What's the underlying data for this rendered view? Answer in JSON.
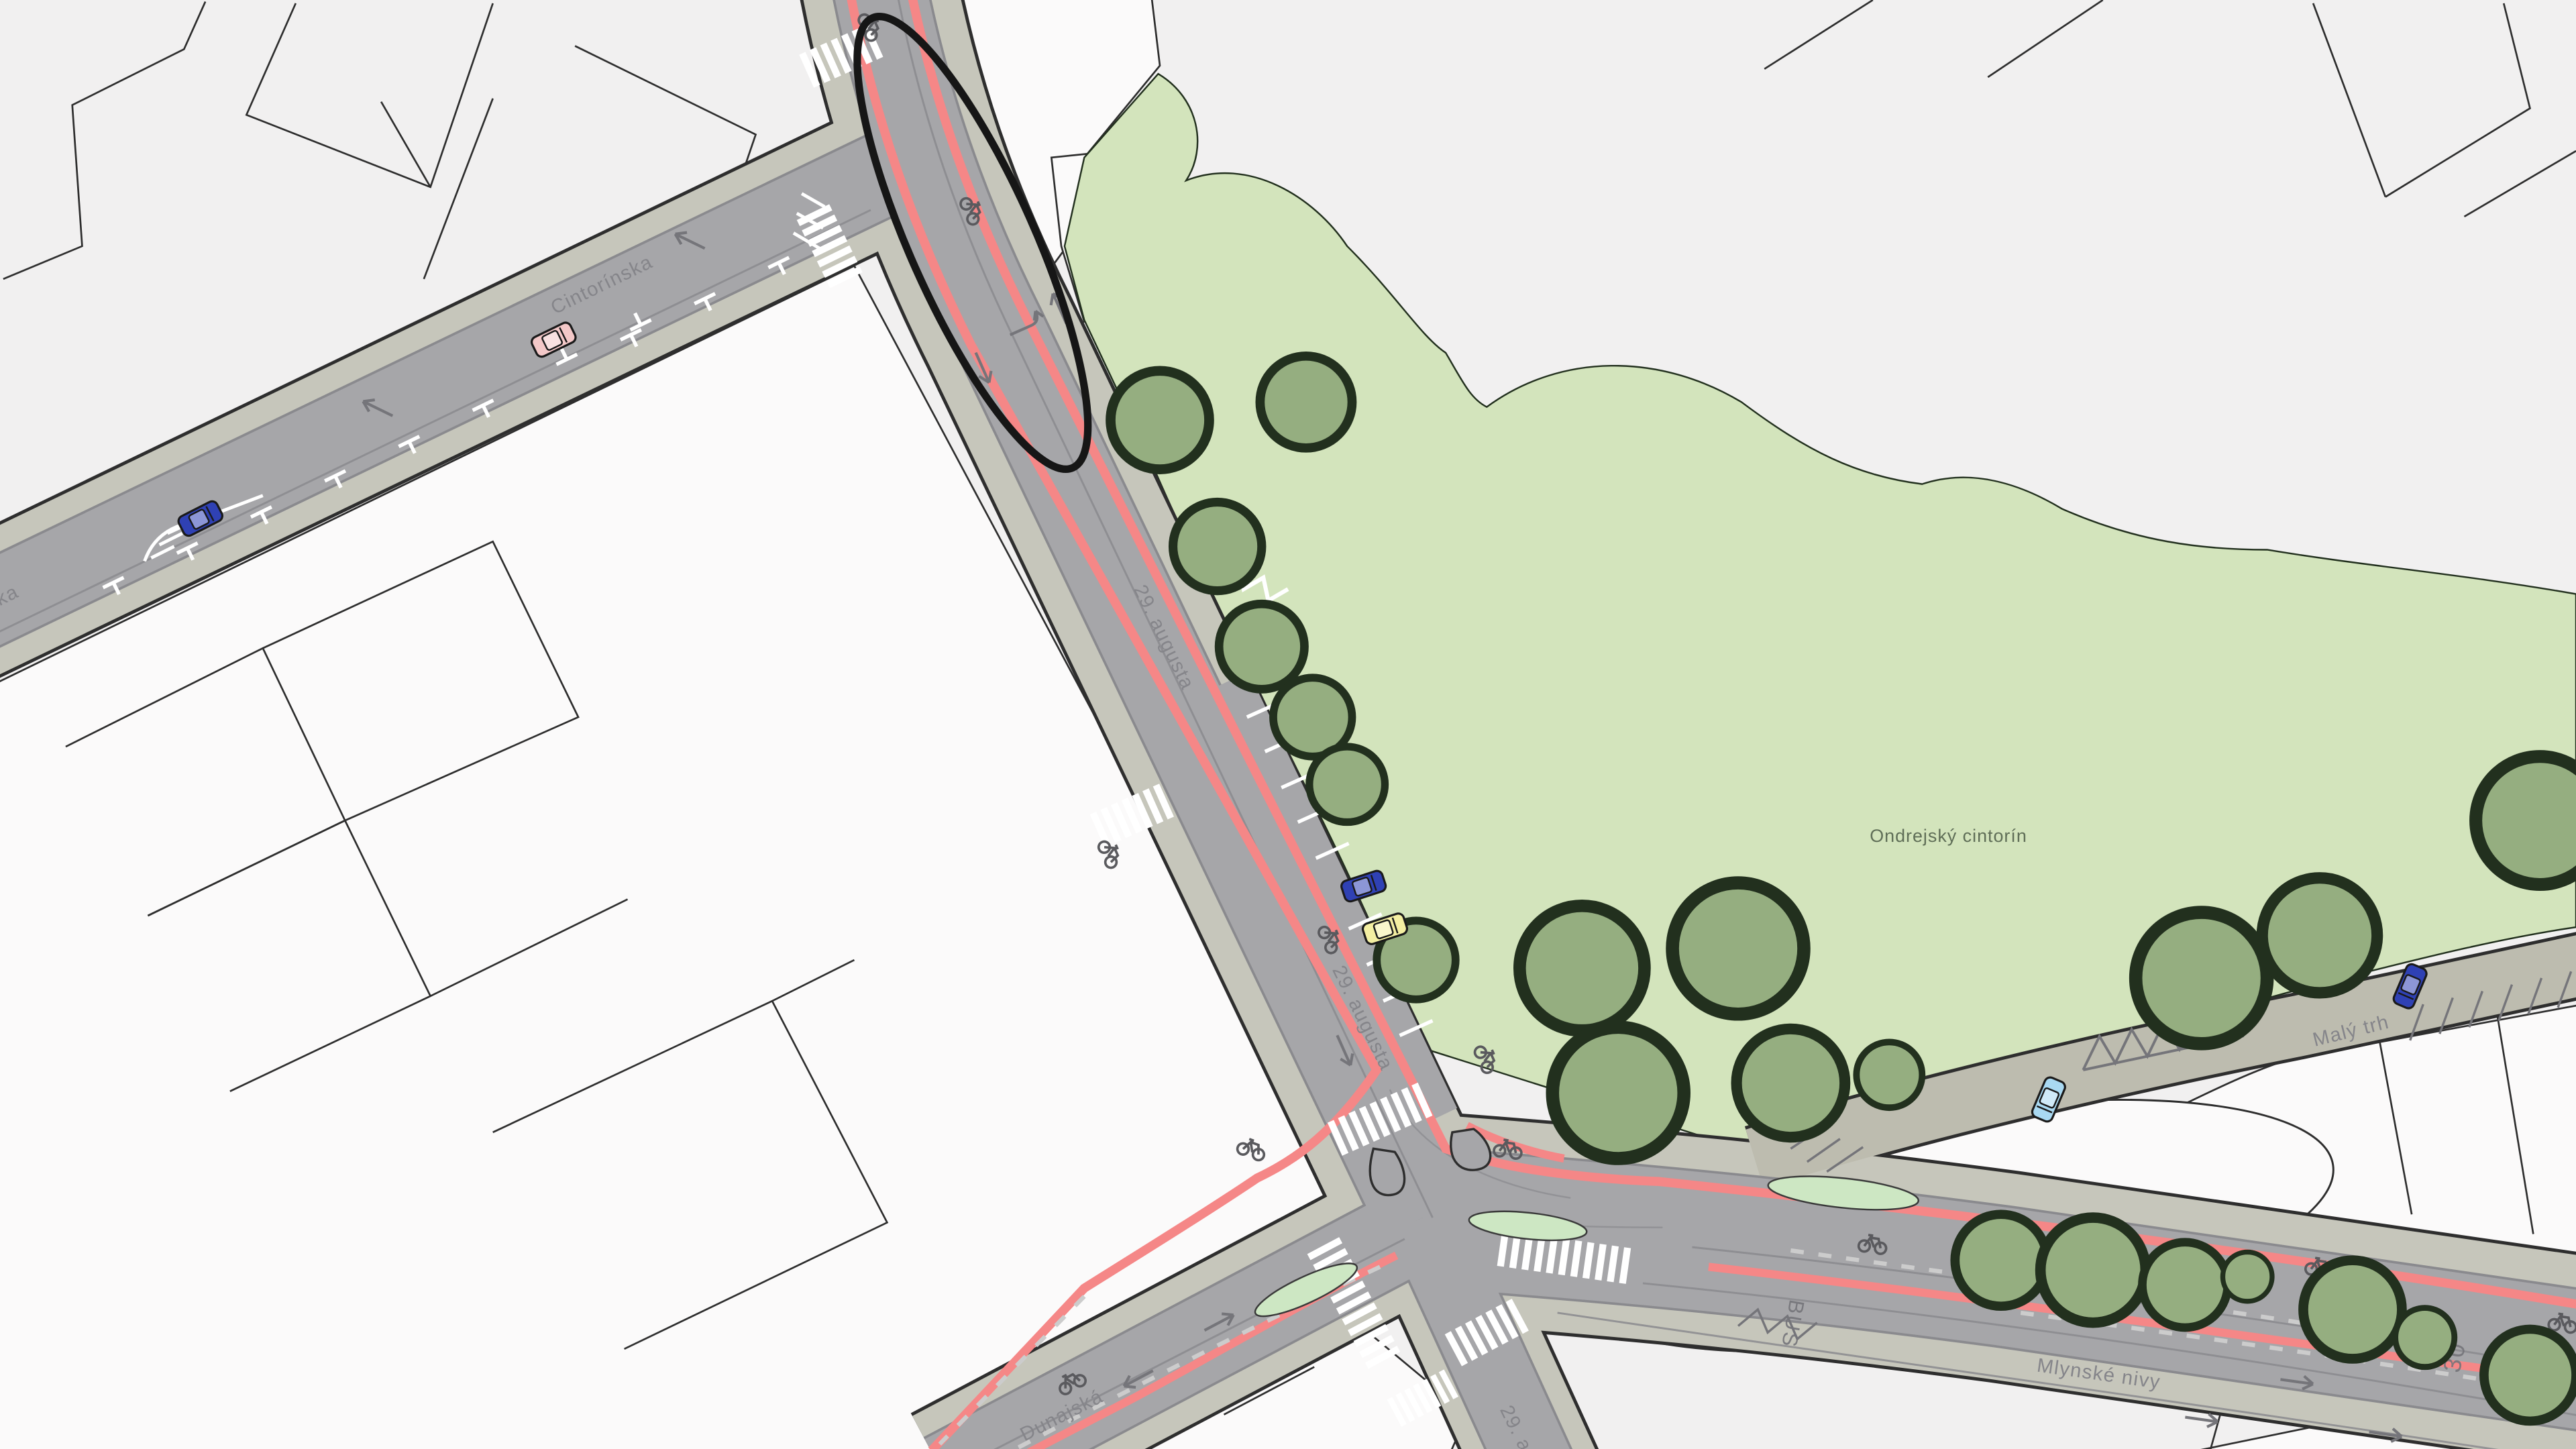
{
  "map": {
    "street_labels": {
      "cintorinska": "Cintorínska",
      "augusta": "29. augusta",
      "mlynske_nivy": "Mlynské nivy",
      "dunajska": "Dunajská",
      "maly_trh": "Malý trh"
    },
    "area_labels": {
      "cemetery": "Ondrejský cintorín"
    },
    "road_markings": {
      "bus_lane": "BUS",
      "zone_word": "ZÓNA",
      "zone_speed": "30"
    },
    "colors": {
      "bg": "#f1f0f0",
      "lot": "#fbfafa",
      "outline": "#2e2e2e",
      "road": "#a6a6a9",
      "road_edge": "#8a8a8e",
      "sidewalk": "#c6c6bb",
      "walkway": "#bdbcaf",
      "park": "#d3e4bc",
      "island": "#cde7c3",
      "tree": "#95ae80",
      "tree_outline": "#22301e",
      "bike_lane": "#f58787",
      "marking_white": "#ffffff",
      "marking_gray": "#75757a",
      "label": "#85858a",
      "cemetery_label": "#5f6e57",
      "loop": "#161616",
      "car_blue": "#2f41b4",
      "car_pink": "#f3c8c8",
      "car_yellow": "#f4efa2",
      "car_cyan": "#a9d9f2"
    }
  }
}
